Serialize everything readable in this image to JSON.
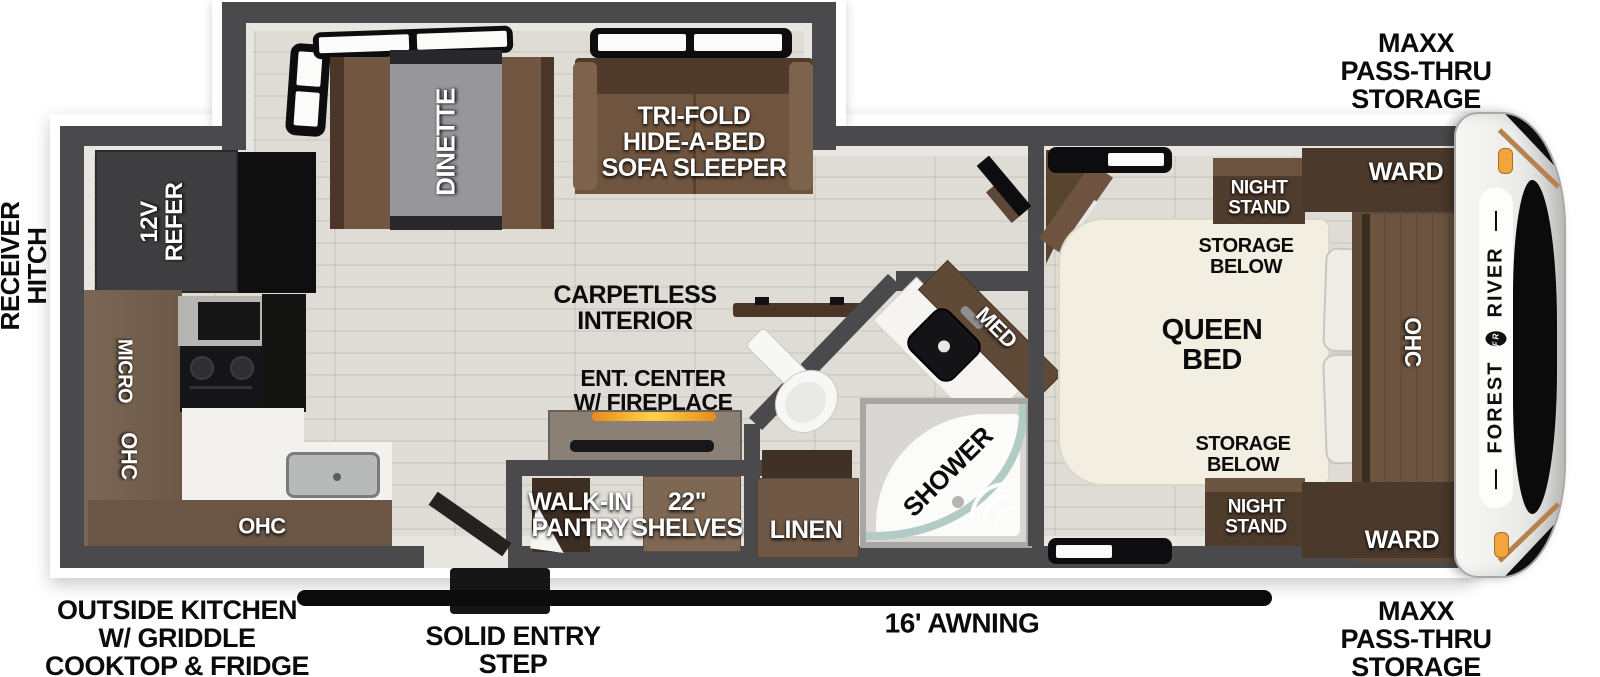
{
  "exterior": {
    "receiver_hitch": "RECEIVER\nHITCH",
    "maxx_storage_top": "MAXX\nPASS-THRU\nSTORAGE",
    "maxx_storage_bottom": "MAXX\nPASS-THRU\nSTORAGE",
    "outside_kitchen": "OUTSIDE KITCHEN\nW/ GRIDDLE\nCOOKTOP & FRIDGE",
    "solid_entry_step": "SOLID ENTRY\nSTEP",
    "awning": "16' AWNING",
    "brand_forest": "FOREST",
    "brand_river": "RIVER",
    "brand_emblem": "FR",
    "brand_rule": "—"
  },
  "living_area": {
    "dinette": "DINETTE",
    "sofa": "TRI-FOLD\nHIDE-A-BED\nSOFA SLEEPER",
    "carpetless": "CARPETLESS\nINTERIOR",
    "ent_center": "ENT. CENTER\nW/ FIREPLACE"
  },
  "kitchen": {
    "refer": "12V\nREFER",
    "micro": "MICRO",
    "ohc_wall": "OHC",
    "ohc_lower": "OHC"
  },
  "pantry": {
    "name": "WALK-IN\nPANTRY",
    "shelves": "22\"\nSHELVES"
  },
  "bathroom": {
    "med": "MED",
    "linen": "LINEN",
    "shower": "SHOWER"
  },
  "bedroom": {
    "bed": "QUEEN\nBED",
    "storage_below_top": "STORAGE\nBELOW",
    "storage_below_bottom": "STORAGE\nBELOW",
    "night_stand_top": "NIGHT\nSTAND",
    "night_stand_bottom": "NIGHT\nSTAND",
    "ward_top": "WARD",
    "ward_bottom": "WARD",
    "ohc": "OHC"
  },
  "colors": {
    "wall": "#4a4a4c",
    "floor": "#d8d6cf",
    "wood_dark": "#4b392b",
    "wood_mid": "#6f5743",
    "amber_light": "#f2a53d"
  }
}
